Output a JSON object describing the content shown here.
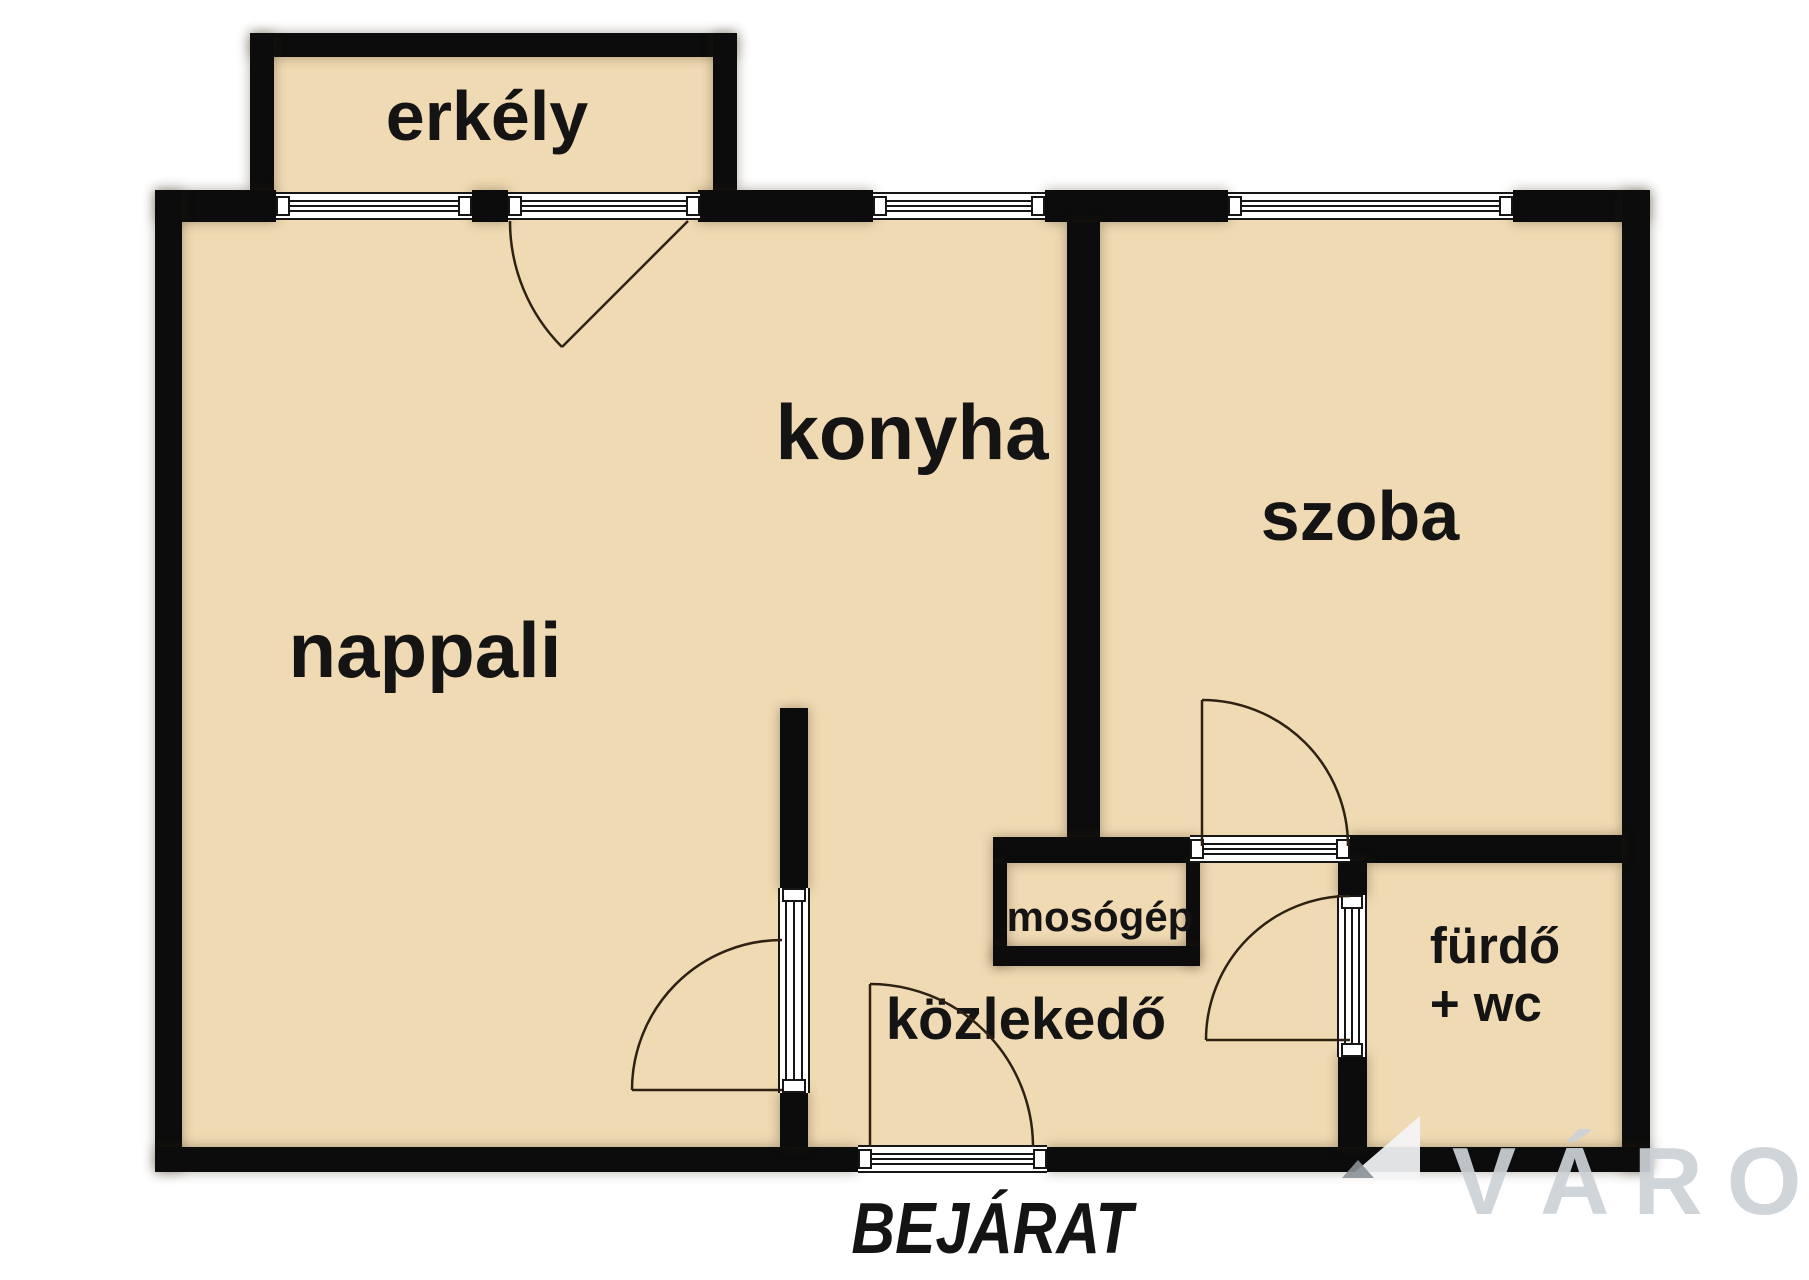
{
  "title": "apartment floor plan",
  "colors": {
    "wall": "#0c0c0c",
    "room_fill": "#f0dab3",
    "background": "#ffffff",
    "door_arc": "#2e2114",
    "watermark_text": "#cdd2d7"
  },
  "rooms": [
    {
      "id": "erkely",
      "label": "erkély"
    },
    {
      "id": "nappali",
      "label": "nappali"
    },
    {
      "id": "konyha",
      "label": "konyha"
    },
    {
      "id": "szoba",
      "label": "szoba"
    },
    {
      "id": "mosogep",
      "label": "mosógép"
    },
    {
      "id": "kozlekedo",
      "label": "közlekedő"
    },
    {
      "id": "furdo",
      "label": "fürdő",
      "label_line2": "+ wc"
    }
  ],
  "annotations": {
    "entrance": "BEJÁRAT"
  },
  "watermark": {
    "text": "VÁRO"
  }
}
